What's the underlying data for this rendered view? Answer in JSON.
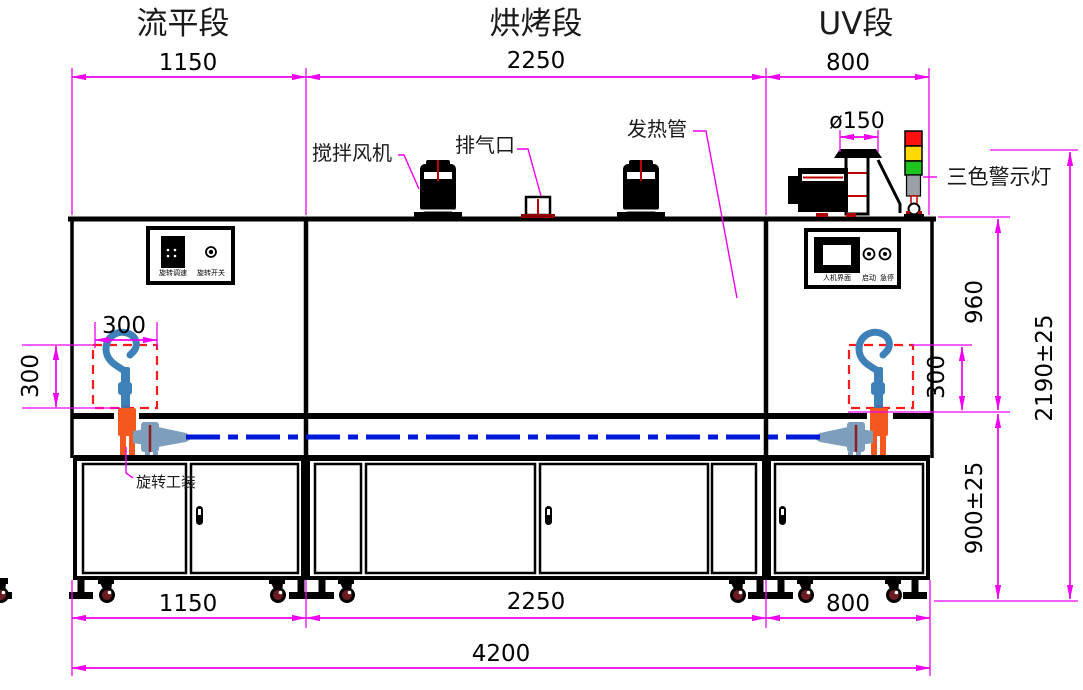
{
  "drawing": {
    "sections": [
      {
        "id": "leveling",
        "title": "流平段",
        "width_label": "1150"
      },
      {
        "id": "baking",
        "title": "烘烤段",
        "width_label": "2250"
      },
      {
        "id": "uv",
        "title": "UV段",
        "width_label": "800"
      }
    ],
    "component_labels": {
      "stir_fan": "搅拌风机",
      "exhaust_port": "排气口",
      "heating_tube": "发热管",
      "duct_diameter": "ø150",
      "tri_color_light": "三色警示灯",
      "rotary_fixture": "旋转工装"
    },
    "leveling_panel": {
      "speed_knob": "旋转调速",
      "rotate_switch": "旋转开关"
    },
    "uv_panel": {
      "hmi": "人机界面",
      "start": "启动",
      "estop": "急停"
    },
    "dimensions": {
      "top_widths": [
        "1150",
        "2250",
        "800"
      ],
      "bottom_widths": [
        "1150",
        "2250",
        "800"
      ],
      "total_width": "4200",
      "fixture_width": "300",
      "fixture_height_left": "300",
      "fixture_height_right": "300",
      "chamber_height": "960",
      "base_height": "900±25",
      "total_height": "2190±25"
    },
    "colors": {
      "dimension": "#F000F0",
      "outline": "#000000",
      "fixture_zone_dashed": "#FF1A1A",
      "conveyor_line": "#0018D8",
      "hook_part": "#3E80B8",
      "spindle": "#F5581E",
      "coupling": "#7E9EBD",
      "light_red": "#FF1010",
      "light_yellow": "#FFD900",
      "light_green": "#1EC41E",
      "wheel": "#6B1B22",
      "accent_red": "#C00000"
    }
  }
}
